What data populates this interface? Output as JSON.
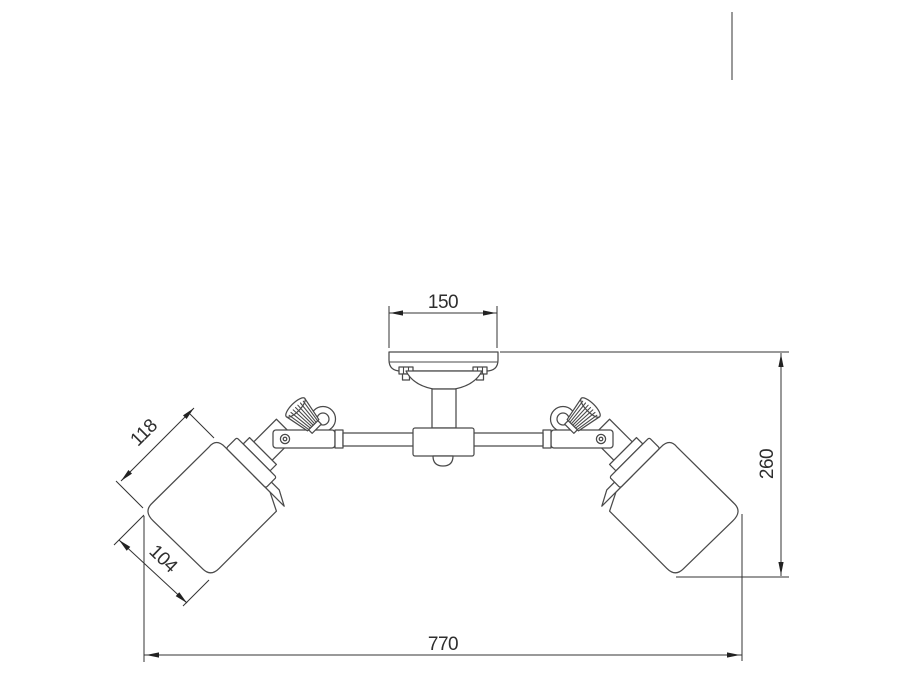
{
  "meta": {
    "kind": "technical dimension line drawing",
    "subject": "two-lamp adjustable ceiling spotlight fixture"
  },
  "palette": {
    "background": "#ffffff",
    "outline": "#4a4a4a",
    "dimension_lines": "#333333",
    "dimension_text": "#2e2e2e",
    "stray_mark": "#999999"
  },
  "dimensions": {
    "canopy_width": "150",
    "shade_length": "118",
    "shade_diameter": "104",
    "fixture_height": "260",
    "overall_width": "770"
  }
}
